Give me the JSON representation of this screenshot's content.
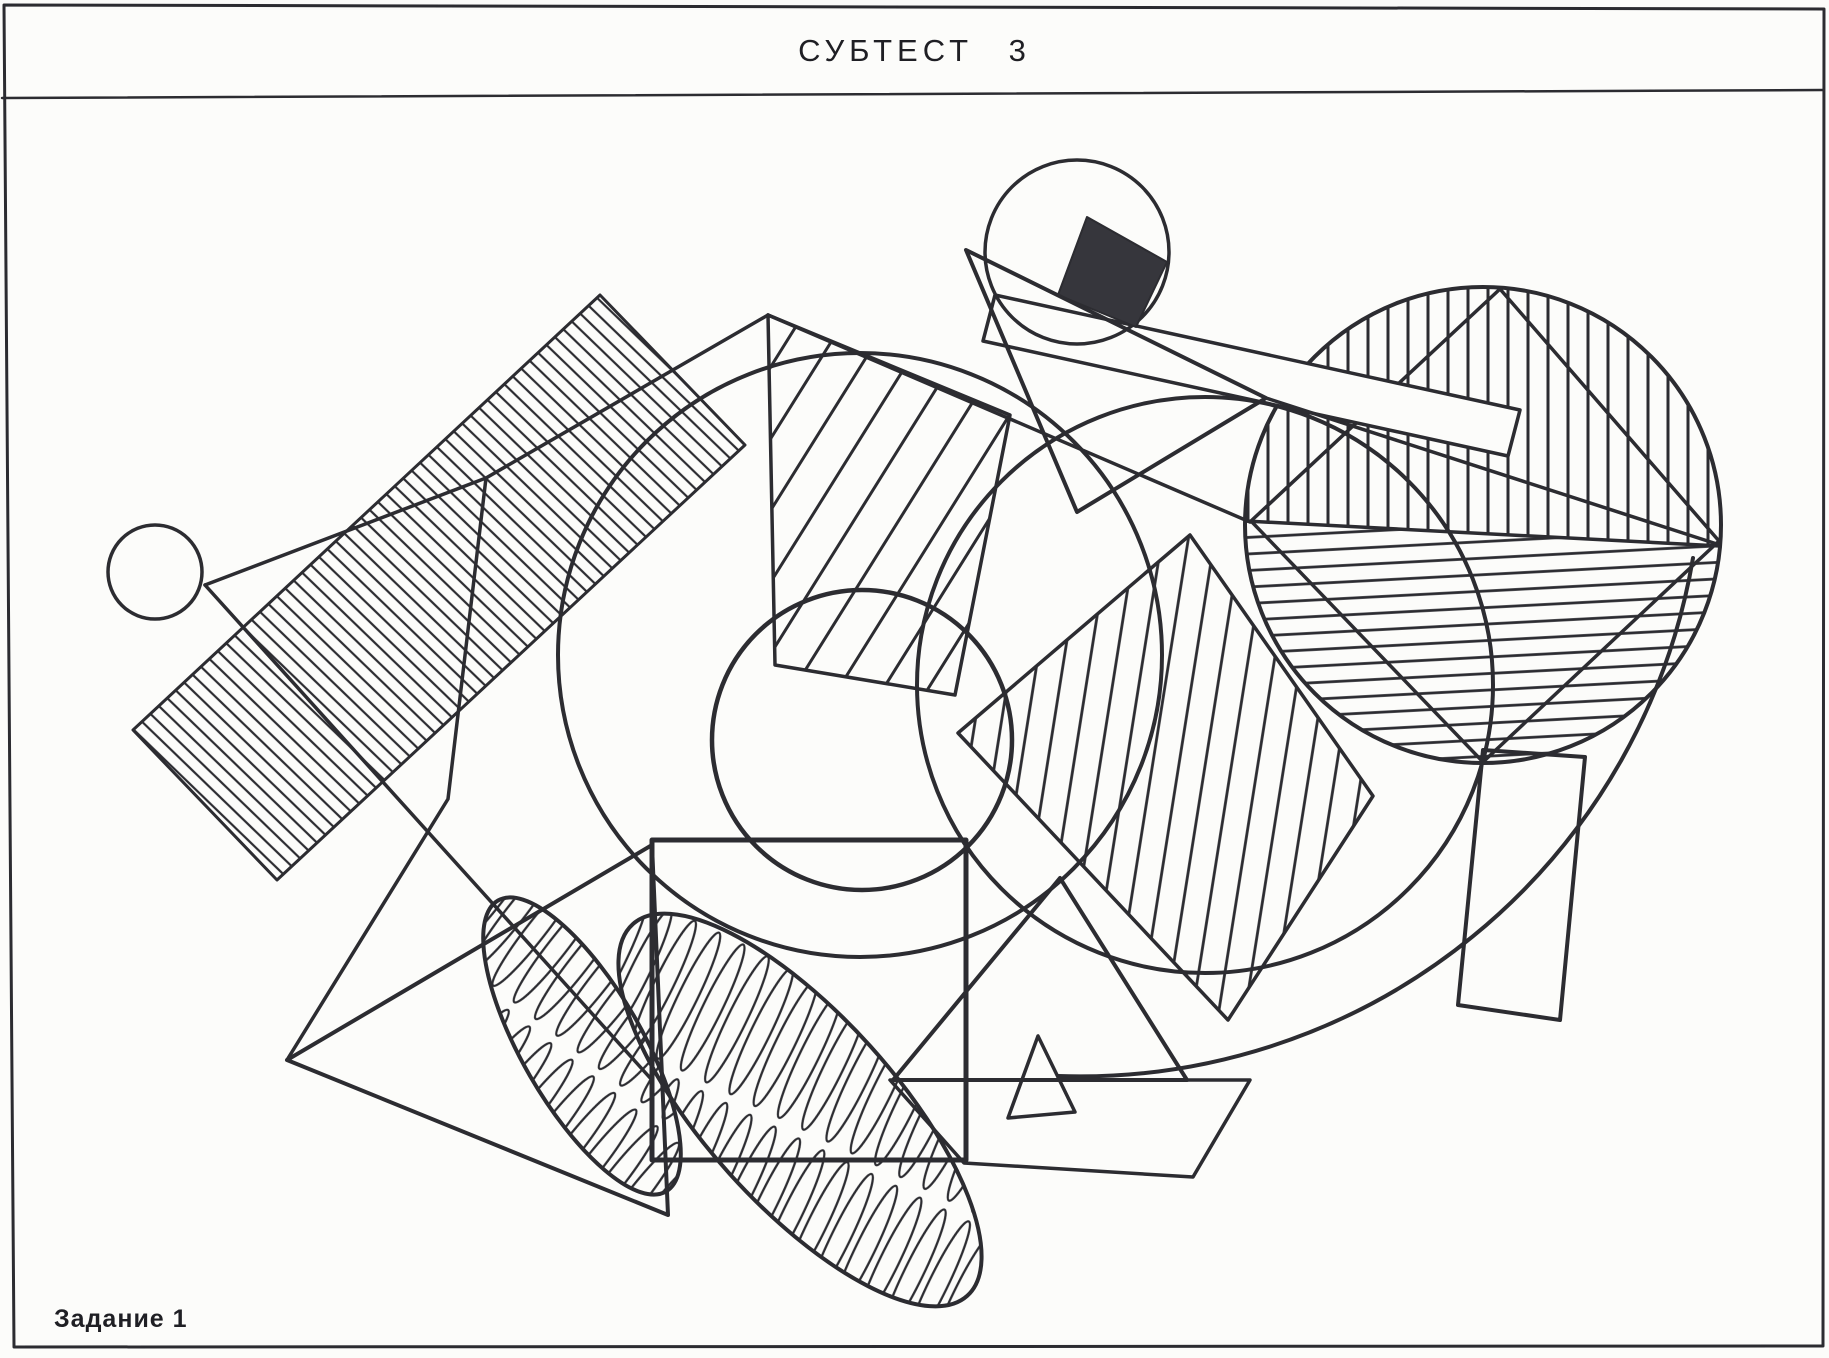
{
  "header": {
    "title": "СУБТЕСТ 3"
  },
  "footer": {
    "task_label": "Задание 1"
  },
  "figure": {
    "description": "overlapping-geometric-figures-test",
    "colors": {
      "ink": "#2c2c31",
      "black_fill": "#36363c",
      "paper": "#fcfcfa"
    },
    "shapes": [
      {
        "name": "outer-border",
        "type": "polygon",
        "points": [
          [
            4,
            5
          ],
          [
            1824,
            9
          ],
          [
            1823,
            1346
          ],
          [
            14,
            1347
          ]
        ],
        "fill": "none",
        "w": 3
      },
      {
        "name": "title-divider",
        "type": "line",
        "p": [
          2,
          98,
          1823,
          90
        ],
        "w": 2.5
      },
      {
        "name": "big-circle-left",
        "type": "circle",
        "c": [
          860,
          655
        ],
        "r": 302,
        "w": 4
      },
      {
        "name": "big-circle-right",
        "type": "circle",
        "c": [
          1205,
          685
        ],
        "r": 288,
        "w": 4
      },
      {
        "name": "big-arc",
        "type": "path",
        "d": "M 1693 558 A 622 622 0 0 1 1058 1076",
        "w": 4
      },
      {
        "name": "inner-circle",
        "type": "circle",
        "c": [
          862,
          740
        ],
        "r": 150,
        "w": 4.5
      },
      {
        "name": "hatched-band",
        "type": "polygon",
        "points": [
          [
            133,
            730
          ],
          [
            600,
            295
          ],
          [
            745,
            445
          ],
          [
            277,
            880
          ]
        ],
        "hatch": "band",
        "w": 3
      },
      {
        "name": "band-apex-line",
        "type": "polyline",
        "points": [
          [
            205,
            585
          ],
          [
            486,
            478
          ],
          [
            768,
            315
          ]
        ],
        "w": 3.5
      },
      {
        "name": "wedge-edge-line",
        "type": "polyline",
        "points": [
          [
            486,
            478
          ],
          [
            448,
            799
          ],
          [
            287,
            1060
          ]
        ],
        "w": 3.5
      },
      {
        "name": "long-diagonal-line",
        "type": "line",
        "p": [
          205,
          585,
          652,
          1080
        ],
        "w": 3.5
      },
      {
        "name": "small-circle",
        "type": "circle",
        "c": [
          155,
          572
        ],
        "r": 47,
        "w": 3.5
      },
      {
        "name": "center-square",
        "type": "polygon",
        "points": [
          [
            652,
            840
          ],
          [
            966,
            840
          ],
          [
            966,
            1160
          ],
          [
            652,
            1160
          ]
        ],
        "fill": "none",
        "w": 5
      },
      {
        "name": "hatched-ellipse-small",
        "type": "ellipse",
        "c": [
          582,
          1046
        ],
        "rx": 168,
        "ry": 60,
        "rot": 60,
        "hatch": "loops",
        "w": 4
      },
      {
        "name": "hatched-ellipse-large",
        "type": "ellipse",
        "c": [
          800,
          1110
        ],
        "rx": 250,
        "ry": 95,
        "rot": 48,
        "hatch": "loops",
        "w": 4
      },
      {
        "name": "bottom-left-triangle",
        "type": "polygon",
        "points": [
          [
            287,
            1060
          ],
          [
            652,
            845
          ],
          [
            668,
            1215
          ]
        ],
        "fill": "none",
        "w": 4
      },
      {
        "name": "center-triangle",
        "type": "polygon",
        "points": [
          [
            1060,
            878
          ],
          [
            893,
            1080
          ],
          [
            1187,
            1080
          ]
        ],
        "fill": "none",
        "w": 4
      },
      {
        "name": "bottom-trapezoid",
        "type": "polygon",
        "points": [
          [
            890,
            1080
          ],
          [
            1250,
            1080
          ],
          [
            1193,
            1177
          ],
          [
            964,
            1163
          ]
        ],
        "fill": "none",
        "w": 3.5
      },
      {
        "name": "small-bottom-triangle",
        "type": "polygon",
        "points": [
          [
            1038,
            1036
          ],
          [
            1008,
            1118
          ],
          [
            1075,
            1112
          ]
        ],
        "fill": "none",
        "w": 3.5
      },
      {
        "name": "center-hatched-quad",
        "type": "polygon",
        "points": [
          [
            768,
            315
          ],
          [
            1010,
            415
          ],
          [
            955,
            695
          ],
          [
            775,
            665
          ]
        ],
        "hatch": "quad",
        "w": 3.5
      },
      {
        "name": "quad-to-circle-line",
        "type": "line",
        "p": [
          768,
          315,
          1250,
          522
        ],
        "w": 3.5
      },
      {
        "name": "right-hatched-diamond",
        "type": "polygon",
        "points": [
          [
            1190,
            535
          ],
          [
            1373,
            796
          ],
          [
            1228,
            1020
          ],
          [
            958,
            733
          ]
        ],
        "hatch": "vtilt",
        "w": 3.5
      },
      {
        "name": "right-hatched-circle",
        "type": "hatchedCircle",
        "c": [
          1483,
          525
        ],
        "r": 238,
        "chord": [
          [
            1246,
            521
          ],
          [
            1720,
            546
          ]
        ],
        "diamond": [
          [
            1500,
            289
          ],
          [
            1719,
            541
          ],
          [
            1483,
            762
          ],
          [
            1251,
            521
          ]
        ],
        "w": 4
      },
      {
        "name": "white-rectangle",
        "type": "polygon",
        "points": [
          [
            995,
            295
          ],
          [
            1520,
            410
          ],
          [
            1508,
            456
          ],
          [
            983,
            341
          ]
        ],
        "fill": "paper",
        "w": 3.5
      },
      {
        "name": "tip-line",
        "type": "line",
        "p": [
          1266,
          398,
          1720,
          545
        ],
        "w": 3.5
      },
      {
        "name": "bottom-rectangle",
        "type": "polygon",
        "points": [
          [
            1483,
            750
          ],
          [
            1585,
            757
          ],
          [
            1560,
            1020
          ],
          [
            1458,
            1005
          ]
        ],
        "fill": "none",
        "w": 4
      },
      {
        "name": "top-circle",
        "type": "circle",
        "c": [
          1077,
          252
        ],
        "r": 92,
        "w": 3.5
      },
      {
        "name": "black-square",
        "type": "polygon",
        "points": [
          [
            1087,
            217
          ],
          [
            1167,
            262
          ],
          [
            1136,
            327
          ],
          [
            1058,
            295
          ]
        ],
        "fill": "black",
        "w": 2
      },
      {
        "name": "top-triangle",
        "type": "polygon",
        "points": [
          [
            966,
            250
          ],
          [
            1266,
            398
          ],
          [
            1077,
            512
          ]
        ],
        "fill": "none",
        "w": 4
      }
    ]
  }
}
